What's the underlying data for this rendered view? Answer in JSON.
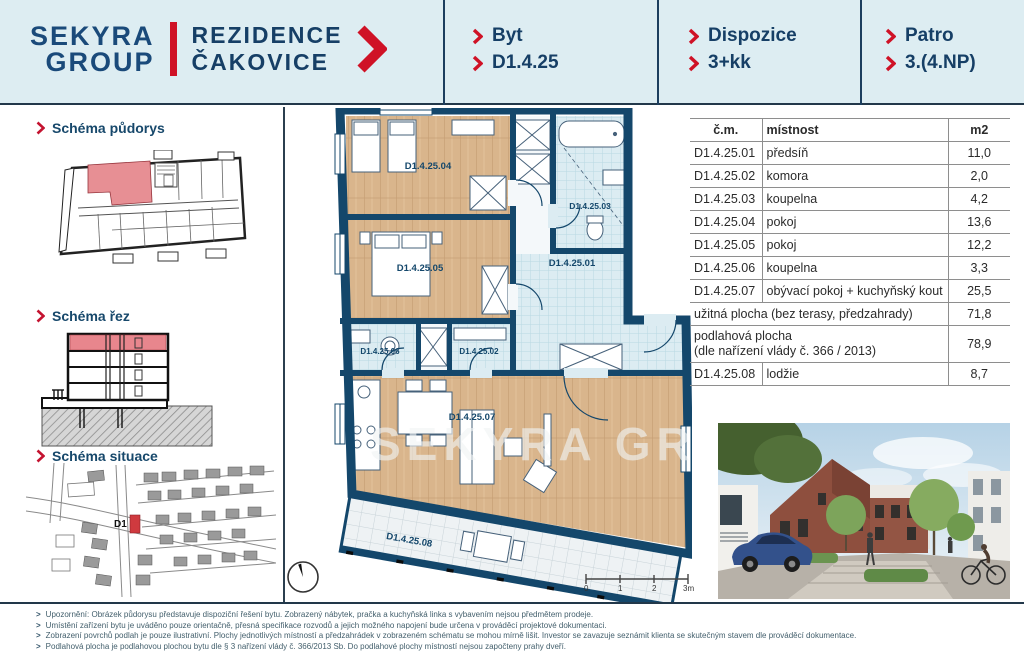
{
  "header": {
    "logo_line1": "SEKYRA",
    "logo_line2": "GROUP",
    "project_line1": "REZIDENCE",
    "project_line2": "ČAKOVICE",
    "info": [
      {
        "label": "Byt",
        "value": "D1.4.25"
      },
      {
        "label": "Dispozice",
        "value": "3+kk"
      },
      {
        "label": "Patro",
        "value": "3.(4.NP)"
      }
    ]
  },
  "sidebar": {
    "sections": [
      {
        "label": "Schéma půdorys"
      },
      {
        "label": "Schéma řez"
      },
      {
        "label": "Schéma situace"
      }
    ],
    "situace_building_label": "D1"
  },
  "floorplan": {
    "watermark": "SEKYRA GR",
    "rooms": [
      {
        "label": "D1.4.25.04"
      },
      {
        "label": "D1.4.25.05"
      },
      {
        "label": "D1.4.25.03"
      },
      {
        "label": "D1.4.25.01"
      },
      {
        "label": "D1.4.25.06"
      },
      {
        "label": "D1.4.25.02"
      },
      {
        "label": "D1.4.25.07"
      },
      {
        "label": "D1.4.25.08"
      }
    ],
    "scale_ticks": [
      "0",
      "1",
      "2",
      "3m"
    ]
  },
  "table": {
    "columns": [
      "č.m.",
      "místnost",
      "m2"
    ],
    "rows": [
      {
        "code": "D1.4.25.01",
        "name": "předsíň",
        "area": "11,0"
      },
      {
        "code": "D1.4.25.02",
        "name": "komora",
        "area": "2,0"
      },
      {
        "code": "D1.4.25.03",
        "name": "koupelna",
        "area": "4,2"
      },
      {
        "code": "D1.4.25.04",
        "name": "pokoj",
        "area": "13,6"
      },
      {
        "code": "D1.4.25.05",
        "name": "pokoj",
        "area": "12,2"
      },
      {
        "code": "D1.4.25.06",
        "name": "koupelna",
        "area": "3,3"
      },
      {
        "code": "D1.4.25.07",
        "name": "obývací pokoj + kuchyňský kout",
        "area": "25,5"
      }
    ],
    "summary_rows": [
      {
        "name": "užitná plocha (bez terasy, předzahrady)",
        "area": "71,8"
      },
      {
        "name_line1": "podlahová plocha",
        "name_line2": "(dle nařízení vlády č. 366 / 2013)",
        "area": "78,9"
      }
    ],
    "final_row": {
      "code": "D1.4.25.08",
      "name": "lodžie",
      "area": "8,7"
    }
  },
  "footer": {
    "notes": [
      "Upozornění: Obrázek půdorysu představuje dispoziční řešení bytu. Zobrazený nábytek, pračka a kuchyňská linka s vybavením nejsou předmětem prodeje.",
      "Umístění zařízení bytu je uváděno pouze orientačně, přesná specifikace rozvodů a jejich možného napojení bude určena v prováděcí projektové dokumentaci.",
      "Zobrazení povrchů podlah je pouze ilustrativní. Plochy jednotlivých místností a předzahrádek v zobrazeném schématu se mohou mírně lišit. Investor se zavazuje seznámit klienta se skutečným stavem dle prováděcí dokumentace.",
      "Podlahová plocha je podlahovou plochou bytu dle § 3 nařízení vlády č. 366/2013 Sb. Do podlahové plochy místností nejsou započteny prahy dveří."
    ]
  },
  "icons": {
    "chevron": ">"
  },
  "colors": {
    "brand_red": "#cf1226",
    "brand_navy": "#163f66",
    "wall_blue": "#14476b",
    "header_bg": "#ddedf2"
  }
}
